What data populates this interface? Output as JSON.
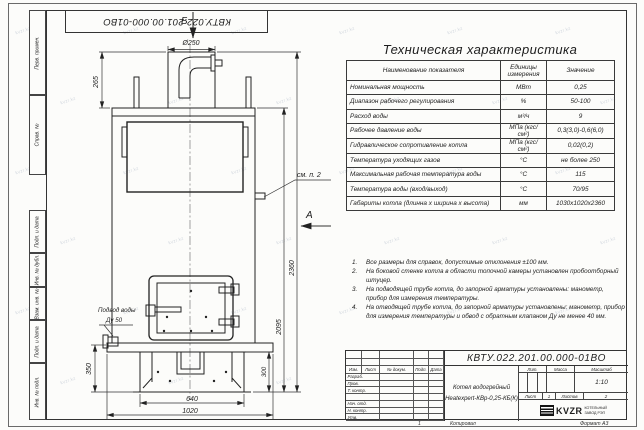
{
  "doc": {
    "number": "КВТУ.022.201.00.000-01ВО",
    "name_line1": "Котел водогрейный",
    "name_line2": "Heatexpert-КВр-0,25-КБ(К)",
    "lit_label": "Лит.",
    "mass_label": "Масса",
    "scale_label": "Масштаб",
    "scale_value": "1:10",
    "sheet_label": "Лист",
    "sheet_value": "1",
    "sheets_label": "Листов",
    "sheets_value": "2",
    "logo_text": "KVZR",
    "logo_sub1": "КОТЕЛЬНЫЙ",
    "logo_sub2": "ЗАВОД РЭП",
    "copied_label": "Копировал",
    "format_label": "Формат А3",
    "zone_mark": "1"
  },
  "title_block": {
    "header_cols": [
      "Изм.",
      "Лист",
      "№ докум.",
      "Подп.",
      "Дата"
    ],
    "rows": [
      "Разраб.",
      "Пров.",
      "Т. контр.",
      "",
      "Нач. отд.",
      "Н. контр.",
      "Утв."
    ]
  },
  "frame_labels": {
    "perv_primen": "Перв. примен.",
    "sprav_no": "Справ. №",
    "podp_data1": "Подп. и дата",
    "inv_dubl": "Инв. № дубл.",
    "vzam_inv": "Взам. инв. №",
    "podp_data2": "Подп. и дата",
    "inv_podl": "Инв. № подл."
  },
  "table": {
    "title": "Техническая характеристика",
    "headers": [
      "Наименование показателя",
      "Единицы измерения",
      "Значение"
    ],
    "rows": [
      [
        "Номинальная мощность",
        "МВт",
        "0,25"
      ],
      [
        "Диапазон рабочего регулирования",
        "%",
        "50-100"
      ],
      [
        "Расход воды",
        "м³/ч",
        "9"
      ],
      [
        "Рабочее давление воды",
        "МПа (кгс/см²)",
        "0,3(3,0)-0,6(6,0)"
      ],
      [
        "Гидравлическое сопротивление котла",
        "МПа (кгс/см²)",
        "0,02(0,2)"
      ],
      [
        "Температура уходящих газов",
        "°С",
        "не более 250"
      ],
      [
        "Максимальная рабочая температура воды",
        "°С",
        "115"
      ],
      [
        "Температура воды (вход/выход)",
        "°С",
        "70/95"
      ],
      [
        "Габариты котла (длинна х ширина х высота)",
        "мм",
        "1030х1020х2360"
      ]
    ]
  },
  "notes_nums": [
    "1.",
    "2.",
    "3.",
    "4."
  ],
  "notes": [
    "Все размеры для справок, допустимые отклонения ±100 мм.",
    "На боковой стенке котла в области топочной камеры установлен пробоотборный штуцер.",
    "На подводящей трубе котла, до запорной арматуры установлены: манометр, прибор для измерения температуры.",
    "На отводящей трубе котла, до запорной арматуры установлены: манометр, прибор для измерения температуры и обвод с обратным клапаном Ду не менее 40 мм."
  ],
  "dimensions": {
    "view_b": "Б",
    "view_a": "А",
    "d250": "Ø250",
    "h265": "265",
    "h2360": "2360",
    "h2095": "2095",
    "h350": "350",
    "h300": "300",
    "w640": "640",
    "w1020": "1020",
    "see_note2": "см. п. 2",
    "water_inlet_line1": "Подвод воды",
    "water_inlet_line2": "Ду 50"
  },
  "watermark": "kvzr.kz"
}
